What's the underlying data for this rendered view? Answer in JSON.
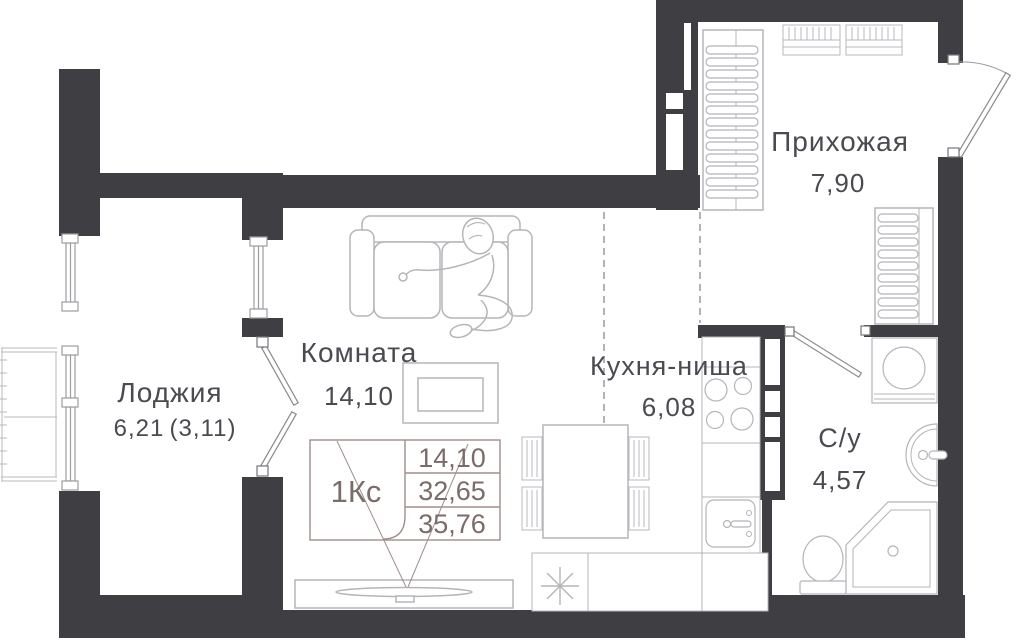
{
  "title": "Studio apartment floor plan",
  "rooms": {
    "hallway": {
      "name": "Прихожая",
      "area": "7,90"
    },
    "room": {
      "name": "Комната",
      "area": "14,10"
    },
    "kitchen": {
      "name": "Кухня-ниша",
      "area": "6,08"
    },
    "loggia": {
      "name": "Лоджия",
      "area": "6,21",
      "area_coeff": "(3,11)"
    },
    "bathroom": {
      "name": "С/у",
      "area": "4,57"
    }
  },
  "info_box": {
    "unit_type": "1Кс",
    "living_area": "14,10",
    "area_no_loggia": "32,65",
    "total_area": "35,76"
  },
  "colors": {
    "wall": "#3E3E43",
    "furniture_outline": "#B5B5BA",
    "label_text": "#4A4A50",
    "table_stroke": "#A08E8C",
    "table_text": "#7B6B69",
    "background": "#FFFFFF"
  }
}
